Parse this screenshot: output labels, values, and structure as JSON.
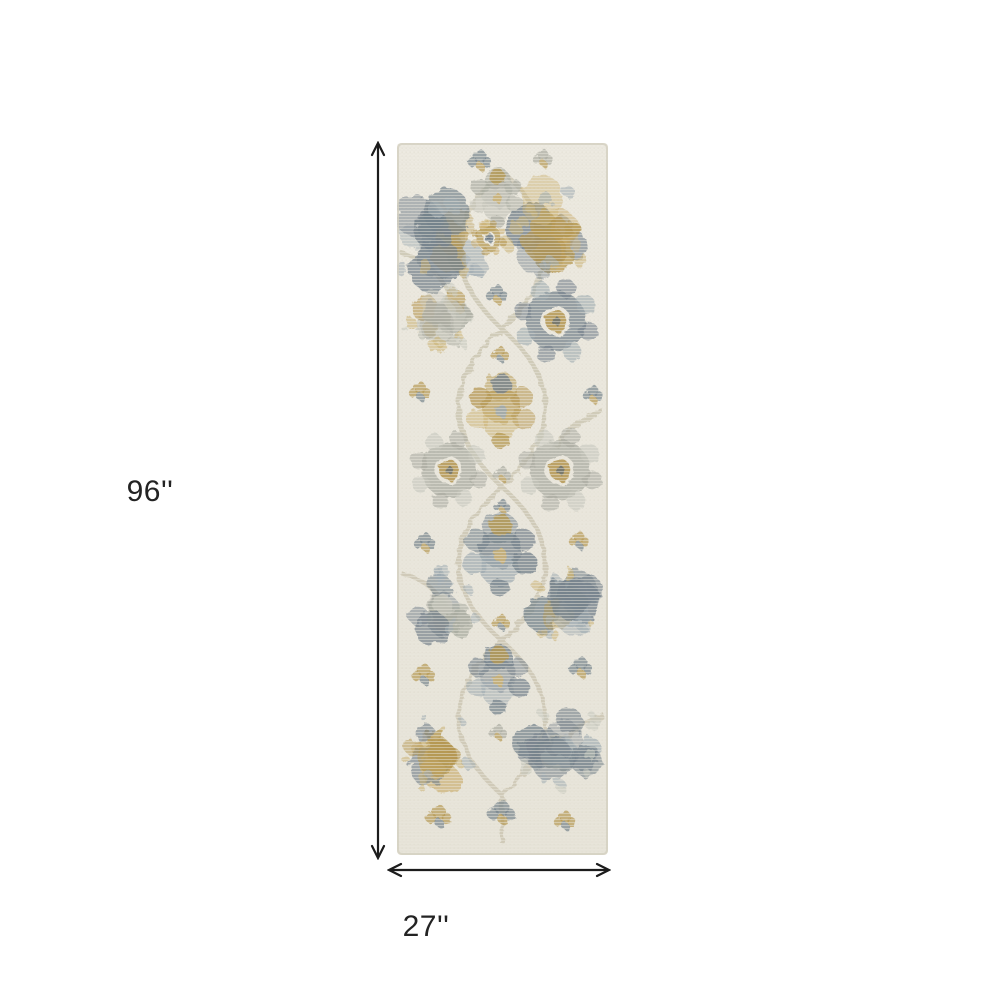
{
  "scene": {
    "background": "#ffffff"
  },
  "dimensions": {
    "arrow_color": "#1c1c1c",
    "text_color": "#232323",
    "vertical": {
      "label": "96''"
    },
    "horizontal": {
      "label": "27''"
    }
  },
  "rug": {
    "base_color": "#e9e6dc",
    "edge_color": "#d3cfc1",
    "palette": {
      "slate": "#6f7d88",
      "slate_light": "#9aa7ae",
      "slate_dark": "#55626c",
      "gold": "#b2934a",
      "gold_light": "#c9ae6e",
      "silver": "#a6a89e",
      "silver_light": "#c3c4ba",
      "vine": "#cbc5b1",
      "grain": "#dcd8c9"
    },
    "motifs": [
      {
        "type": "sprig",
        "x": 83,
        "y": 16,
        "r": 13,
        "color": "slate",
        "accent": "gold"
      },
      {
        "type": "sprig",
        "x": 146,
        "y": 14,
        "r": 11,
        "color": "silver",
        "accent": "gold"
      },
      {
        "type": "cluster",
        "x": 45,
        "y": 95,
        "r": 52,
        "color": "slate",
        "accent": "gold"
      },
      {
        "type": "medallion",
        "x": 100,
        "y": 55,
        "r": 30,
        "color": "silver",
        "accent": "gold"
      },
      {
        "type": "cluster",
        "x": 160,
        "y": 85,
        "r": 51,
        "color": "gold",
        "accent": "slate"
      },
      {
        "type": "rosette",
        "x": 92,
        "y": 95,
        "r": 15,
        "color": "gold",
        "accent": "slate"
      },
      {
        "type": "sprig",
        "x": 100,
        "y": 150,
        "r": 12,
        "color": "slate",
        "accent": "gold"
      },
      {
        "type": "cluster",
        "x": 45,
        "y": 178,
        "r": 38,
        "color": "silver",
        "accent": "gold"
      },
      {
        "type": "rosette",
        "x": 159,
        "y": 178,
        "r": 36,
        "color": "slate",
        "accent": "gold"
      },
      {
        "type": "sprig",
        "x": 103,
        "y": 210,
        "r": 10,
        "color": "gold",
        "accent": "slate"
      },
      {
        "type": "sprig",
        "x": 23,
        "y": 247,
        "r": 12,
        "color": "gold",
        "accent": "slate"
      },
      {
        "type": "sprig",
        "x": 196,
        "y": 250,
        "r": 11,
        "color": "slate",
        "accent": "gold"
      },
      {
        "type": "medallion",
        "x": 104,
        "y": 268,
        "r": 38,
        "color": "gold",
        "accent": "slate"
      },
      {
        "type": "rosette",
        "x": 52,
        "y": 327,
        "r": 33,
        "color": "silver",
        "accent": "gold"
      },
      {
        "type": "rosette",
        "x": 163,
        "y": 327,
        "r": 36,
        "color": "silver",
        "accent": "gold"
      },
      {
        "type": "sprig",
        "x": 105,
        "y": 330,
        "r": 10,
        "color": "silver",
        "accent": "gold"
      },
      {
        "type": "sprig",
        "x": 105,
        "y": 362,
        "r": 9,
        "color": "slate",
        "accent": "gold"
      },
      {
        "type": "medallion",
        "x": 103,
        "y": 412,
        "r": 42,
        "color": "slate",
        "accent": "gold"
      },
      {
        "type": "sprig",
        "x": 28,
        "y": 398,
        "r": 12,
        "color": "slate",
        "accent": "gold"
      },
      {
        "type": "sprig",
        "x": 182,
        "y": 396,
        "r": 11,
        "color": "gold",
        "accent": "slate"
      },
      {
        "type": "cluster",
        "x": 43,
        "y": 462,
        "r": 38,
        "color": "silver",
        "accent": "slate"
      },
      {
        "type": "cluster",
        "x": 168,
        "y": 458,
        "r": 40,
        "color": "slate",
        "accent": "gold"
      },
      {
        "type": "sprig",
        "x": 104,
        "y": 478,
        "r": 10,
        "color": "gold",
        "accent": "slate"
      },
      {
        "type": "medallion",
        "x": 101,
        "y": 537,
        "r": 35,
        "color": "slate",
        "accent": "gold"
      },
      {
        "type": "sprig",
        "x": 27,
        "y": 530,
        "r": 13,
        "color": "gold",
        "accent": "slate"
      },
      {
        "type": "sprig",
        "x": 184,
        "y": 523,
        "r": 13,
        "color": "slate",
        "accent": "gold"
      },
      {
        "type": "cluster",
        "x": 41,
        "y": 609,
        "r": 42,
        "color": "gold",
        "accent": "slate"
      },
      {
        "type": "cluster",
        "x": 165,
        "y": 607,
        "r": 46,
        "color": "slate",
        "accent": "silver"
      },
      {
        "type": "sprig",
        "x": 101,
        "y": 588,
        "r": 10,
        "color": "silver",
        "accent": "gold"
      },
      {
        "type": "sprig",
        "x": 42,
        "y": 672,
        "r": 14,
        "color": "gold",
        "accent": "slate"
      },
      {
        "type": "sprig",
        "x": 105,
        "y": 668,
        "r": 15,
        "color": "slate",
        "accent": "gold"
      },
      {
        "type": "sprig",
        "x": 168,
        "y": 676,
        "r": 12,
        "color": "gold",
        "accent": "slate"
      }
    ]
  }
}
